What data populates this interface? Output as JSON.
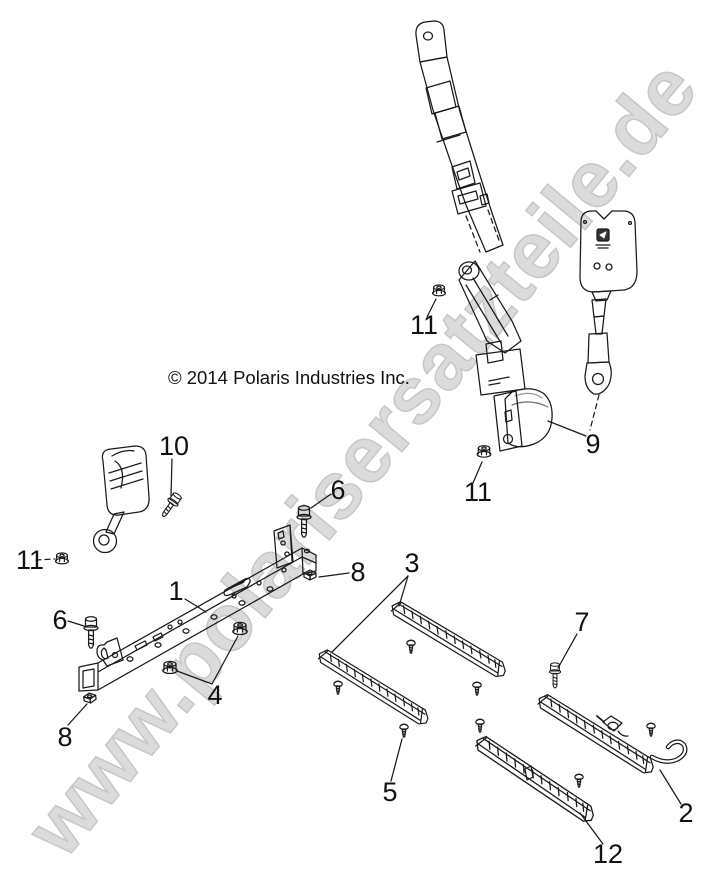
{
  "watermark": {
    "text": "www.polarisersatzteile.de",
    "color": "#dbdbdb"
  },
  "copyright": "© 2014 Polaris Industries Inc.",
  "callouts": {
    "part1": "1",
    "part2": "2",
    "part3": "3",
    "part4": "4",
    "part5": "5",
    "part6_left": "6",
    "part6_right": "6",
    "part7": "7",
    "part8_left": "8",
    "part8_right": "8",
    "part9": "9",
    "part10": "10",
    "part11_left": "11",
    "part11_top": "11",
    "part11_bottom": "11",
    "part12": "12"
  }
}
